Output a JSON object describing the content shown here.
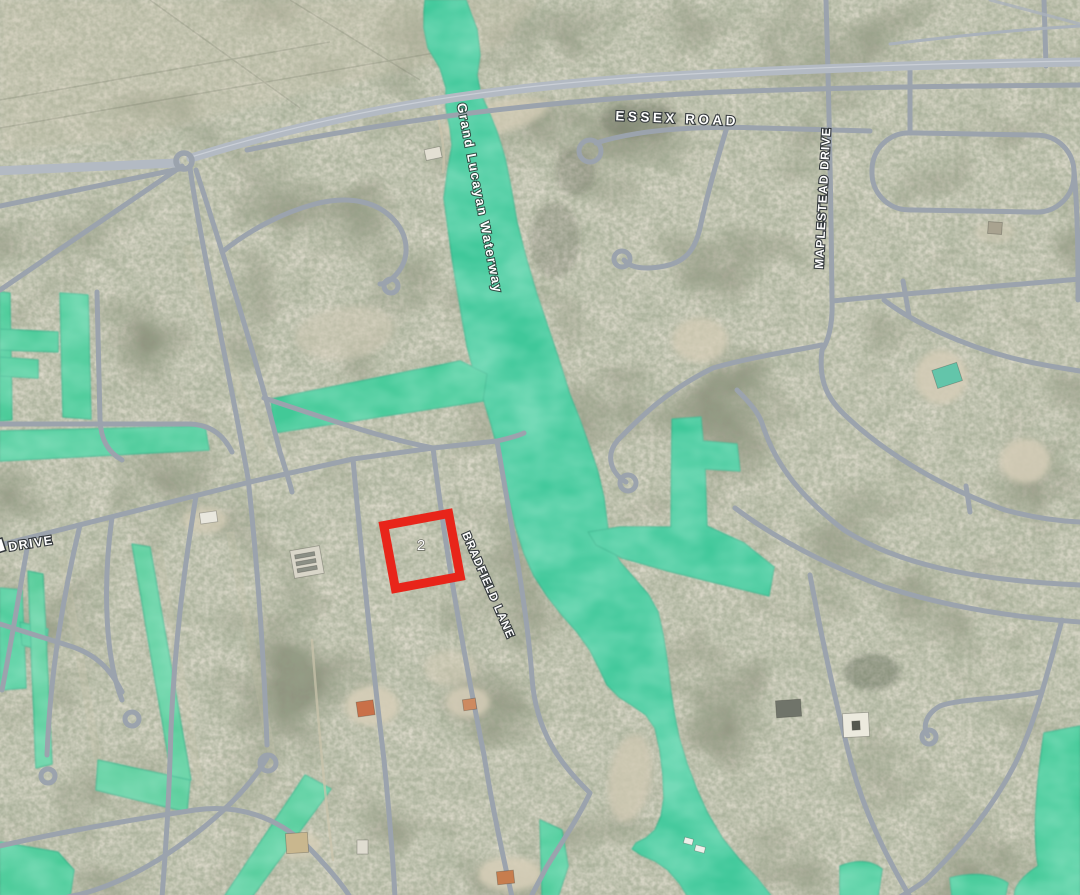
{
  "map": {
    "marker": {
      "number": "2",
      "color": "#e8251a"
    },
    "labels": {
      "essex_road": "ESSEX ROAD",
      "maplestead_drive": "MAPLESTEAD DRIVE",
      "bradfield_lane": "BRADFIELD LANE",
      "drive_partial": "DRIVE",
      "waterway": "Grand Lucayan Waterway"
    },
    "colors": {
      "water": "#3fc89a",
      "terrain": "#90927f",
      "road": "#9ba3ad",
      "highway": "#b3bac3",
      "sand": "#d5cdb7",
      "label_text": "#ffffff",
      "label_outline": "#33383c",
      "marker_red": "#e8251a"
    }
  }
}
